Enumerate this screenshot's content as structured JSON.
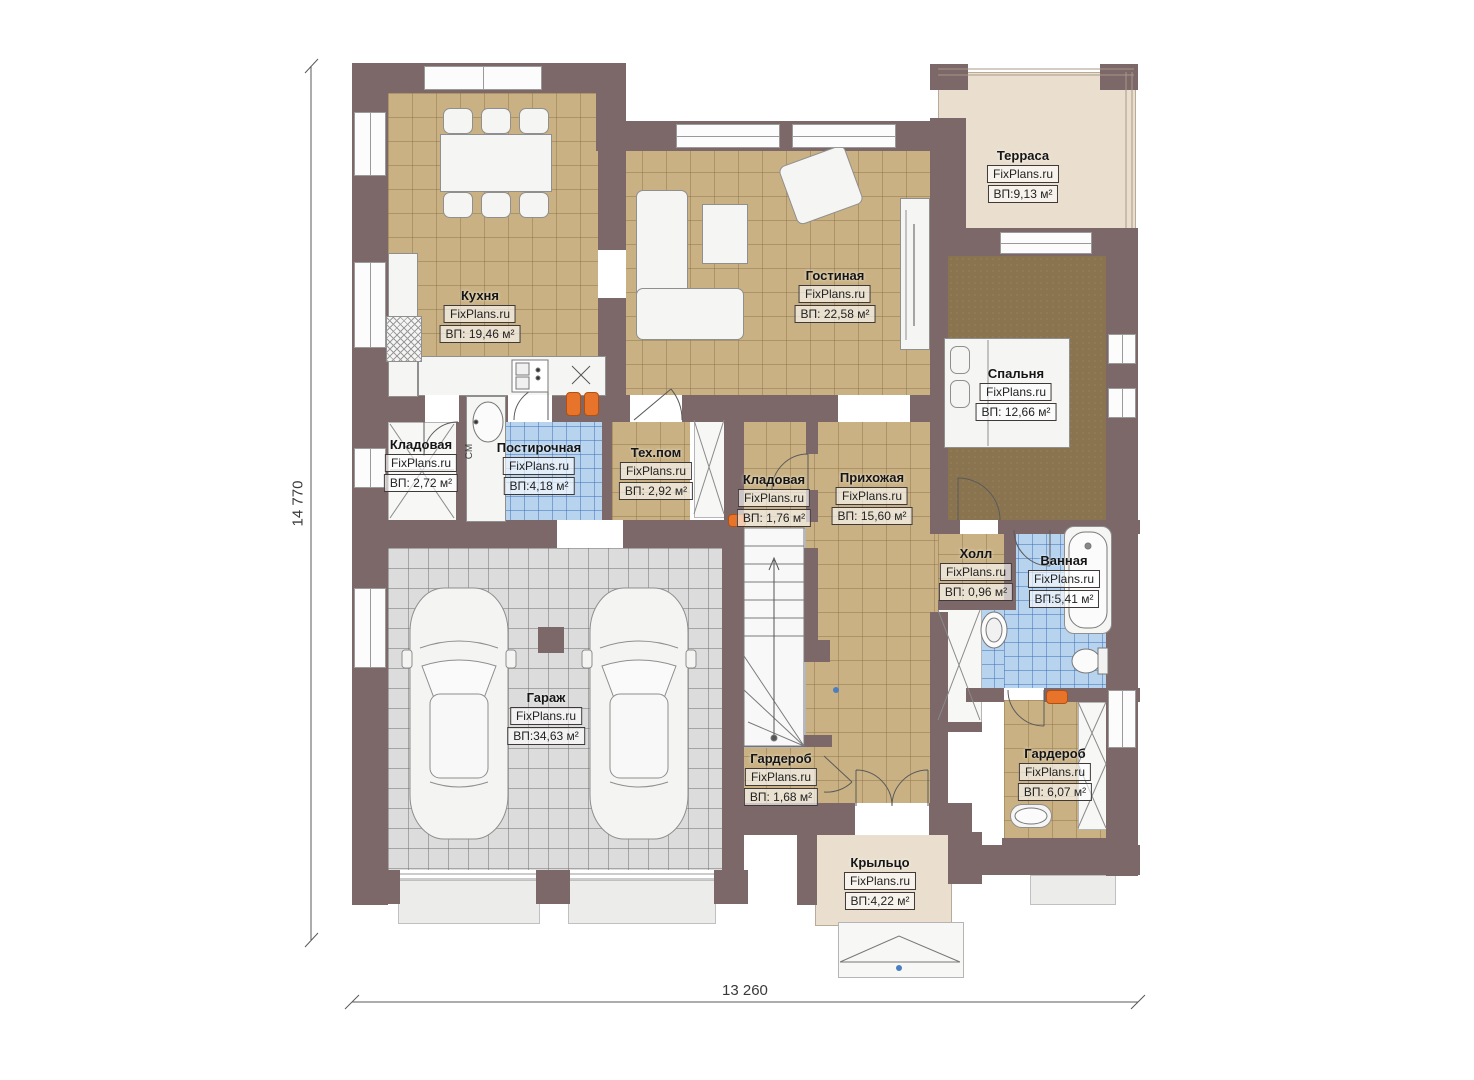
{
  "plan": {
    "watermark": "FixPlans.ru",
    "rooms": [
      {
        "name": "Кухня",
        "area": "ВП: 19,46 м²"
      },
      {
        "name": "Гостиная",
        "area": "ВП: 22,58 м²"
      },
      {
        "name": "Терраса",
        "area": "ВП:9,13 м²"
      },
      {
        "name": "Спальня",
        "area": "ВП: 12,66 м²"
      },
      {
        "name": "Кладовая",
        "area": "ВП: 2,72 м²"
      },
      {
        "name": "Постирочная",
        "area": "ВП:4,18 м²"
      },
      {
        "name": "Тех.пом",
        "area": "ВП: 2,92 м²"
      },
      {
        "name": "Кладовая",
        "area": "ВП: 1,76 м²"
      },
      {
        "name": "Прихожая",
        "area": "ВП: 15,60 м²"
      },
      {
        "name": "Холл",
        "area": "ВП: 0,96 м²"
      },
      {
        "name": "Ванная",
        "area": "ВП:5,41 м²"
      },
      {
        "name": "Гараж",
        "area": "ВП:34,63 м²"
      },
      {
        "name": "Гардероб",
        "area": "ВП: 1,68 м²"
      },
      {
        "name": "Гардероб",
        "area": "ВП: 6,07 м²"
      },
      {
        "name": "Крыльцо",
        "area": "ВП:4,22 м²"
      }
    ],
    "dimensions": {
      "vertical": "14 770",
      "horizontal": "13 260"
    },
    "annotations": {
      "washer": "СМ"
    },
    "colors": {
      "wall": "#7c6769",
      "tile_tan": "#c9b183",
      "tile_blue": "#b7d3ee",
      "tile_gray": "#dcdcdc",
      "carpet": "#8a7450",
      "terrace_floor": "#eadfce",
      "accent": "#e8732a"
    }
  }
}
